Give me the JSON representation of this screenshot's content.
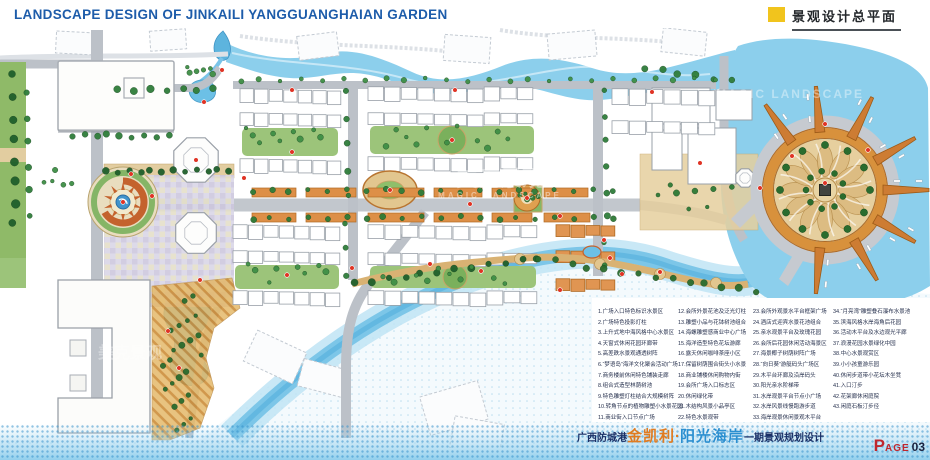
{
  "header": {
    "title_en": "LANDSCAPE DESIGN OF JINKAILI YANGGUANGHAIAN GARDEN",
    "section_title": "景观设计总平面"
  },
  "watermark": {
    "cn": "美克景观",
    "en": "MAGIC LANDSCAPE"
  },
  "legend": {
    "columns": [
      [
        "1.广场入口特色标识水景区",
        "2.广场特色投影灯柱",
        "3.上升式地中海风格中心水景区",
        "4.天窗式休闲花园环廊带",
        "5.高差跌水景观通透树阵",
        "6.“梦语岛”海洋文化聚会活动广场",
        "7.商务楼前休闲特色铺装走廊",
        "8.组合式造型林荫树池",
        "9.特色雕塑灯柱结合大规模树阵",
        "10.转角节点的植物雕塑小水景花园",
        "11.商业街入口节点广场"
      ],
      [
        "12.会所外景花池及泛光灯柱",
        "13.雕塑小品与花钵树池组合",
        "14.海螺雕塑感商业中心广场",
        "15.海洋造型特色花坛游廊",
        "16.露天休闲咖啡茶座小区",
        "17.保留树荫围合街头小水景",
        "18.商业铺楼休闲购物内街",
        "19.会所广场入口标志区",
        "20.休闲绿化带",
        "21.木结构风景小品亭区",
        "22.特色水景观带"
      ],
      [
        "23.会所外观景水平台框架广场",
        "24.酒店式迎宾水景花池组合",
        "25.亲水观景平台及玫瑰花园",
        "26.会所后花园休闲活动海景区",
        "27.海景椰子树荫树阵广场",
        "28.“向日葵”游艇码头广场区",
        "29.木平台环廊及沿岸码头",
        "30.阳光亲水阶梯带",
        "31.水岸观景平台节点小广场",
        "32.水岸风景线慢跑游步道",
        "33.海岸观景休闲景观木平台"
      ],
      [
        "34.“月亮湾”雕塑叠石瀑布水景池",
        "35.滨海风格水岸海角后花园",
        "36.活动木平台及水边观光平廊",
        "37.浪漫花园水景绿化中园",
        "38.中心水景观赏区",
        "39.小小孩童游乐园",
        "40.休闲步道带小花坛木坐凳",
        "41.入口汀步",
        "42.花架廊休闲庭院",
        "43.闲庭石板汀步径"
      ]
    ]
  },
  "footer": {
    "location": "广西防城港",
    "brand": "金凯利",
    "dot": "·",
    "project": "阳光海岸",
    "phase": "一期景观规划设计",
    "page_word_initial": "P",
    "page_word_rest": "AGE",
    "page_num": "03"
  },
  "colors": {
    "accent_yellow": "#f1c41d",
    "title_blue": "#1d5caa",
    "brand_orange": "#e07b20",
    "project_blue": "#2b8fd0",
    "page_red": "#c0272d",
    "water": "#8ccfec",
    "marina_orange": "#d8913c",
    "vegetation_green": "#2f7d3a"
  }
}
